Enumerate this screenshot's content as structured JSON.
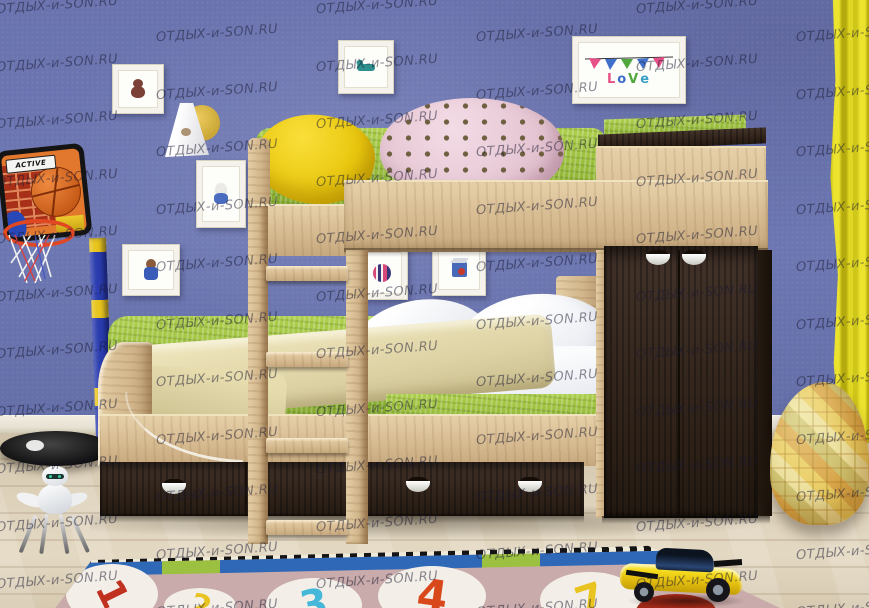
{
  "image_type": "product-photo",
  "subject": "Two-tone children's bunk bed (light oak and wenge) with wardrobe and drawers in a kids room",
  "watermark": {
    "text": "ОТДЫХ-и-SON.RU"
  },
  "basketball_backboard": {
    "brand": "ACTIVE"
  },
  "frames": {
    "love": {
      "letters": [
        "L",
        "o",
        "V",
        "e"
      ]
    },
    "motifs": [
      "teddy-bear",
      "teal-horse",
      "love-banner",
      "bunny",
      "bear-in-overalls",
      "striped-ball",
      "toy-cube"
    ]
  },
  "rug": {
    "characters": [
      {
        "char": "1",
        "color": "#c03120"
      },
      {
        "char": "2",
        "color": "#e9c320"
      },
      {
        "char": "3",
        "color": "#45b7d9"
      },
      {
        "char": "4",
        "color": "#d9481a"
      },
      {
        "char": "7",
        "color": "#e9c320"
      }
    ],
    "field_color": "#c8abaa",
    "border_colors": [
      "#3068b8",
      "#9cc040",
      "#141414",
      "#f0ead8"
    ]
  },
  "colors": {
    "wall": "#6a73ae",
    "curtain": "#e0d724",
    "oak_wood": "#d6ba90",
    "wenge_wood": "#2e2118",
    "mattress_green": "#8fb434",
    "yellow_pillow": "#e8c60c",
    "pink_pillow": "#e3c2d0",
    "beige_blanket": "#ddd2a4",
    "floor": "#ddd1ba",
    "beanbag": "#d9a649",
    "toy_car": "#e3bd0e"
  },
  "objects": [
    "bunk-bed",
    "wardrobe",
    "drawers",
    "ladder",
    "basketball-stand",
    "wall-lamp",
    "picture-frames",
    "yellow-curtain",
    "bean-bag",
    "alphabet-rug",
    "toy-car",
    "robot-toy"
  ]
}
